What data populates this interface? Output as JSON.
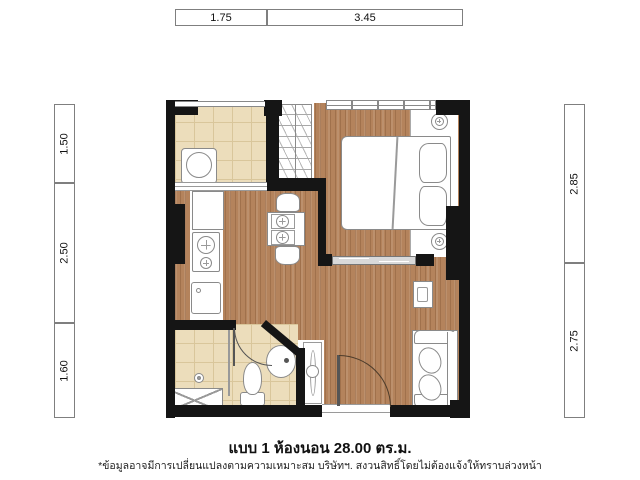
{
  "plan": {
    "name": "one-bedroom-unit-floor-plan",
    "area_label": "28.00",
    "title": "แบบ 1 ห้องนอน  28.00 ตร.ม.",
    "disclaimer": "*ข้อมูลอาจมีการเปลี่ยนแปลงตามความเหมาะสม บริษัทฯ. สงวนสิทธิ์โดยไม่ต้องแจ้งให้ทราบล่วงหน้า"
  },
  "dimensions": {
    "top": [
      {
        "label": "1.75"
      },
      {
        "label": "3.45"
      }
    ],
    "left": [
      {
        "label": "1.50"
      },
      {
        "label": "2.50"
      },
      {
        "label": "1.60"
      }
    ],
    "right": [
      {
        "label": "2.85"
      },
      {
        "label": "2.75"
      }
    ]
  },
  "rooms": [
    {
      "name": "balcony-laundry"
    },
    {
      "name": "bedroom"
    },
    {
      "name": "living-dining"
    },
    {
      "name": "kitchen"
    },
    {
      "name": "bathroom"
    }
  ],
  "furniture": [
    "washing-machine",
    "wardrobe",
    "bed",
    "pillows",
    "nightstands",
    "dining-table",
    "dining-chairs",
    "fridge",
    "stove",
    "kitchen-sink",
    "sofa",
    "tv-console",
    "toilet",
    "wash-basin",
    "shower",
    "tall-cabinet"
  ],
  "colors": {
    "wall": "#151515",
    "wood_floor": "#b4835c",
    "tile_floor": "#ecddbb",
    "furniture_outline": "#8a8a8a",
    "dimension_border": "#7f7f7f",
    "background": "#ffffff"
  }
}
